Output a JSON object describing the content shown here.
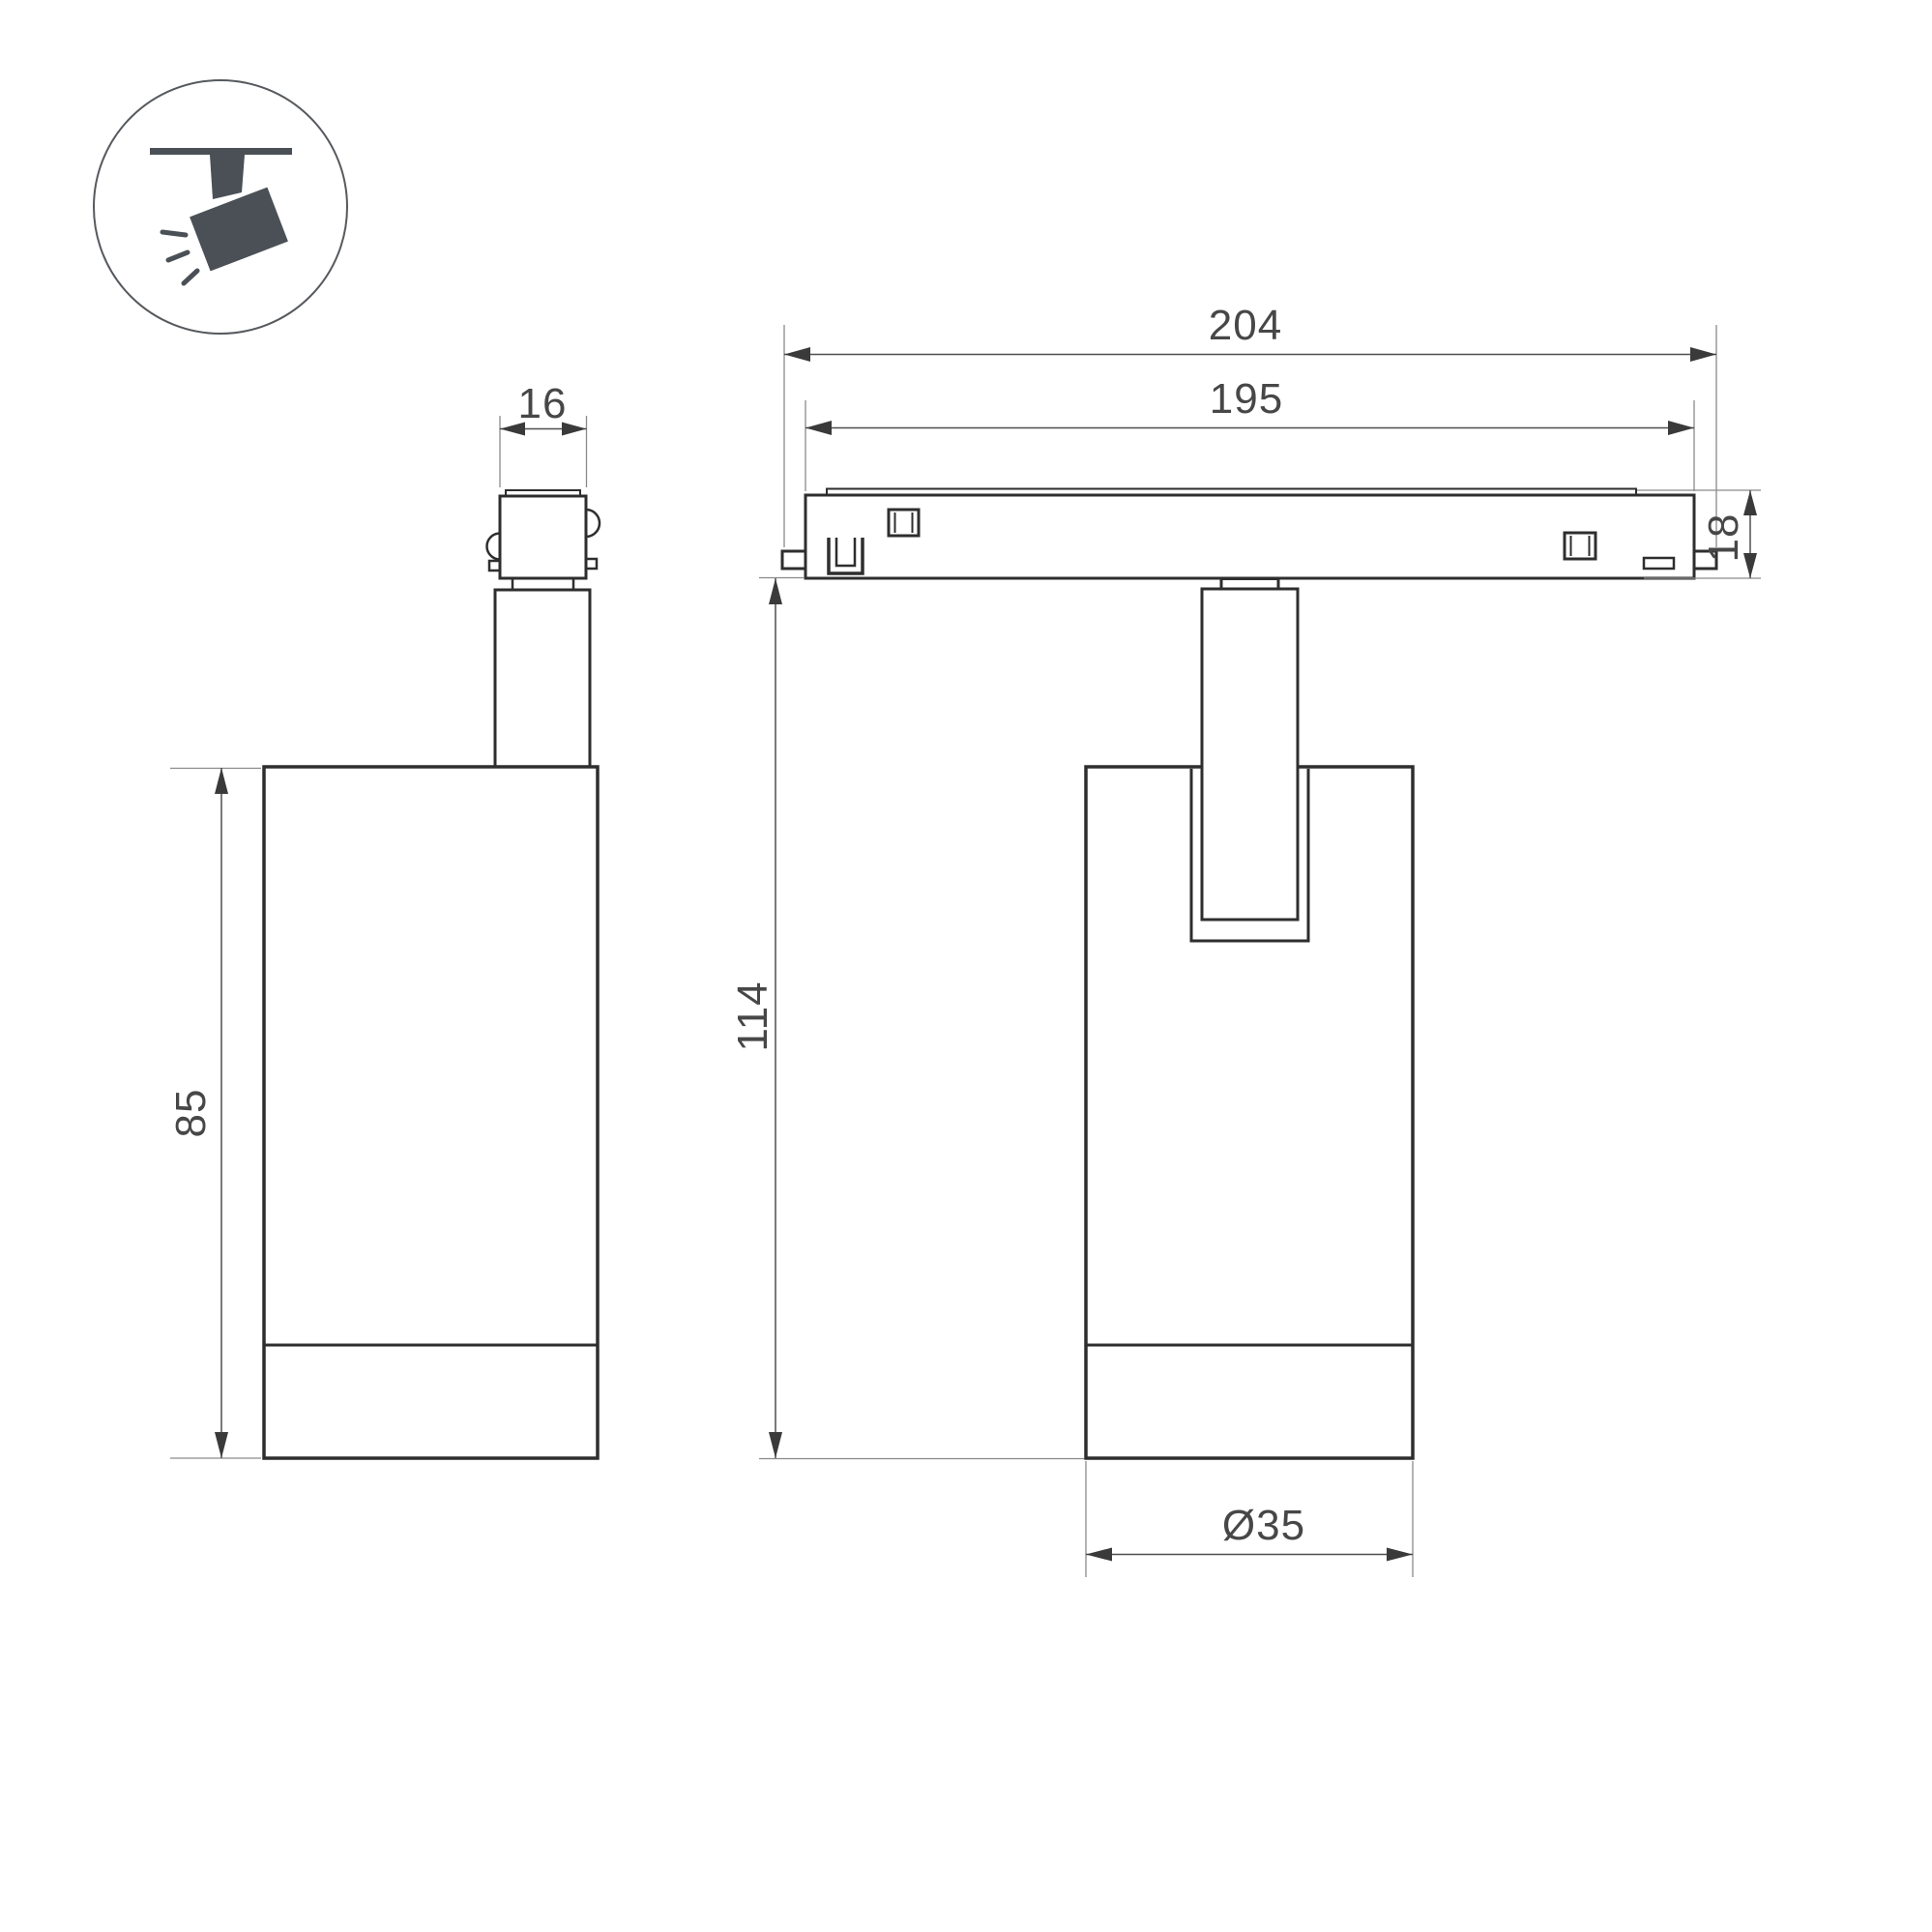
{
  "colors": {
    "background": "#ffffff",
    "outline": "#2e2e2e",
    "dimension_line": "#4f4f4f",
    "witness_line": "#8a8a8a",
    "dimension_text": "#474747",
    "icon": "#4a5056"
  },
  "icon": {
    "symbol": "track-spotlight-pictogram"
  },
  "dimensions": {
    "connector_width": "16",
    "body_height": "85",
    "overall_length": "204",
    "track_length": "195",
    "track_height": "18",
    "overall_height": "114",
    "body_diameter": "Ø35"
  }
}
